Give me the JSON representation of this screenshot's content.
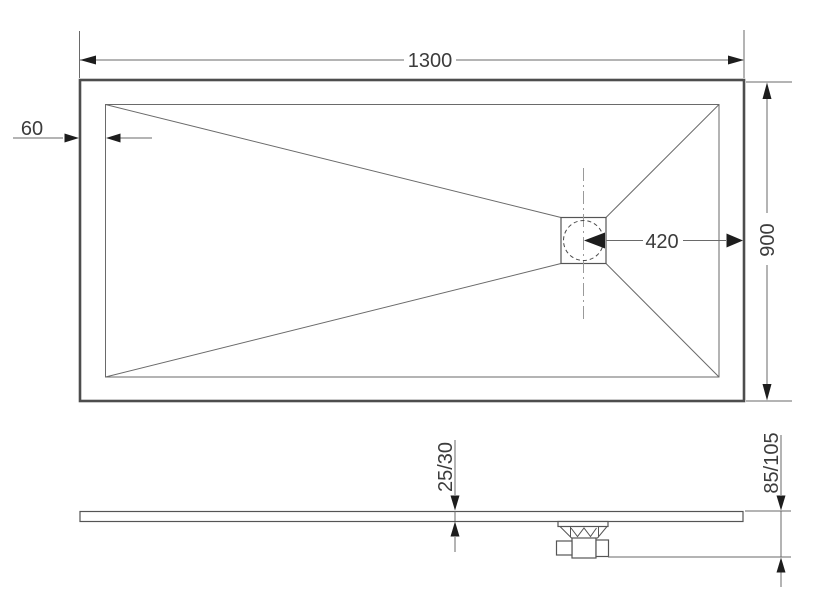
{
  "drawing": {
    "dims": {
      "width": "1300",
      "depth": "900",
      "border": "60",
      "drain_offset": "420",
      "thickness": "25/30",
      "height": "85/105"
    },
    "colors": {
      "background": "#ffffff",
      "outline_heavy": "#4d4d4d",
      "line": "#6a6a6a",
      "arrow": "#1d1d1d",
      "text": "#3c3c3c",
      "centerline": "#9a9a9a"
    }
  }
}
